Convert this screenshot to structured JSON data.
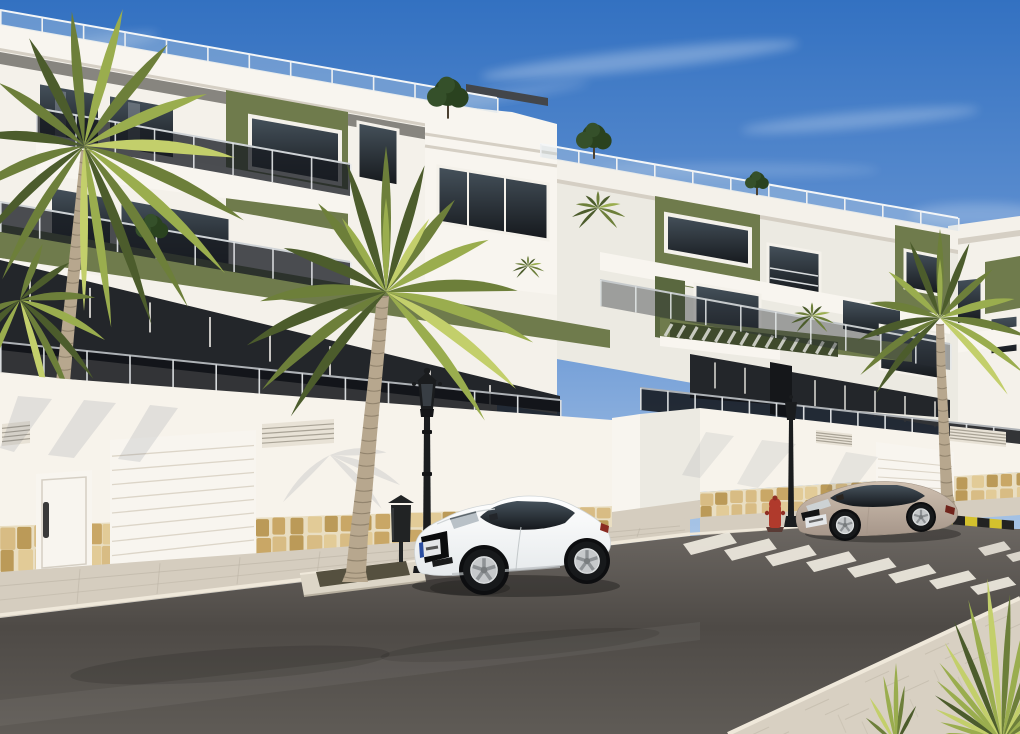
{
  "image": {
    "kind": "photorealistic 3D architectural render",
    "subject": "modern white-and-olive apartment complex along a sunny street",
    "time_of_day": "clear sunny day"
  },
  "objects": {
    "buildings": [
      {
        "id": "left-apartment-block",
        "facade": [
          "white",
          "olive-green"
        ],
        "floors": 3,
        "features": [
          "glass balustrade balconies",
          "roof terrace railing",
          "green fascia band",
          "street wall with garage",
          "stone masonry base"
        ]
      },
      {
        "id": "right-apartment-block",
        "facade": [
          "white",
          "olive-green"
        ],
        "floors": 3,
        "features": [
          "green accent towers",
          "slatted pergola",
          "glass balustrades"
        ]
      },
      {
        "id": "far-apartment-block",
        "facade": [
          "white",
          "olive-green"
        ]
      }
    ],
    "vehicles": [
      {
        "id": "white-coupe",
        "description": "white sports coupe parked at the curb",
        "license_plate": "unreadable"
      },
      {
        "id": "beige-coupe",
        "description": "beige coupe parked further along the street",
        "license_plate": "unreadable"
      }
    ],
    "street_furniture": [
      "classic black lantern street lamp",
      "second distant street lamp",
      "black litter bin",
      "red fire hydrant",
      "yellow-black striped curb"
    ],
    "street": [
      "paved sidewalk",
      "asphalt road",
      "zebra pedestrian crossing",
      "palm tree planter island"
    ],
    "vegetation": [
      "large palm tree left",
      "large palm tree centre",
      "palm tree right",
      "foreground spiky plant",
      "rooftop shrubs",
      "balcony plants"
    ]
  },
  "palette": {
    "sky_top": "#3371c1",
    "sky_mid": "#6f9bd6",
    "sky_low": "#b6cfea",
    "sky_horizon": "#dde7f3",
    "cloud_white": "#ffffff",
    "facade_white": "#f4f1ea",
    "facade_bright": "#f8f5ef",
    "facade_dim": "#eceae2",
    "soffit_grey": "#73726c",
    "olive_green": "#6f7b4c",
    "olive_light": "#7f8b58",
    "olive_dark": "#5a683f",
    "glass_top": "#46525c",
    "glass_bottom": "#15181c",
    "interior_dark": "#23262a",
    "parapet_edge": "#d5cfc4",
    "pergola_base": "#3f4a2c",
    "pergola_slat": "#d6d7d0",
    "stone_a": "#d8bc84",
    "stone_b": "#c9a766",
    "stone_c": "#e2cb97",
    "stone_d": "#bb9a58",
    "stone_joint": "#e9dec2",
    "wall_white": "#f7f3eb",
    "vent_face": "#e8e2d6",
    "vent_line": "#a9a396",
    "door_handle": "#3a3a3a",
    "garage_line": "#dcd5c8",
    "sidewalk": "#d5cdbf",
    "curb_light": "#efe8da",
    "walk_line": "#b9b1a2",
    "fg_walk": "#d8d0c2",
    "island": "#ddd6c7",
    "island_soil": "#55503f",
    "road_top": "#6e6964",
    "road_mid": "#4e4a46",
    "road_low": "#5f5b56",
    "stripe_white": "#efeadf",
    "curb_yellow": "#d4c12d",
    "curb_black": "#222222",
    "lamp_black": "#1a1c1e",
    "lamp_glass": "#3c4248",
    "bin_dark": "#212324",
    "hydrant_red": "#b03a2c",
    "hydrant_dark": "#8f2f24",
    "car_white_hi": "#ffffff",
    "car_white_lo": "#e6eaec",
    "car_trim": "#cfd4d6",
    "plate_white": "#e4e6e8",
    "plate_blue": "#2a4da0",
    "tail_red": "#8a2b22",
    "car_beige_hi": "#cfc0b0",
    "car_beige_lo": "#a6968a",
    "beige_trim": "#9f9183",
    "tire_black": "#17191b",
    "rim_silver": "#c6c9cb",
    "rim_shade": "#8e9295",
    "arch_black": "#0d0e10",
    "trunk_light": "#b7a78e",
    "trunk_ring": "#6e614e",
    "palm_dark": "#4c5c2c",
    "palm_green": "#6d7f3a",
    "palm_light": "#9aad4e",
    "palm_yellow": "#c3cf6b",
    "tuft_green": "#35502a",
    "shadow_blue": "rgba(44,53,80,0.10)",
    "car_shadow": "rgba(0,0,0,0.30)",
    "rail_roof_glass": "rgba(200,218,233,0.35)",
    "rail_dark_glass": "rgba(26,30,36,0.78)",
    "rail_mid_glass": "rgba(40,46,52,0.40)",
    "rail_ter_glass": "rgba(16,19,23,0.85)",
    "post_white": "#eef0f1",
    "post_soft": "#d8dbdd"
  }
}
